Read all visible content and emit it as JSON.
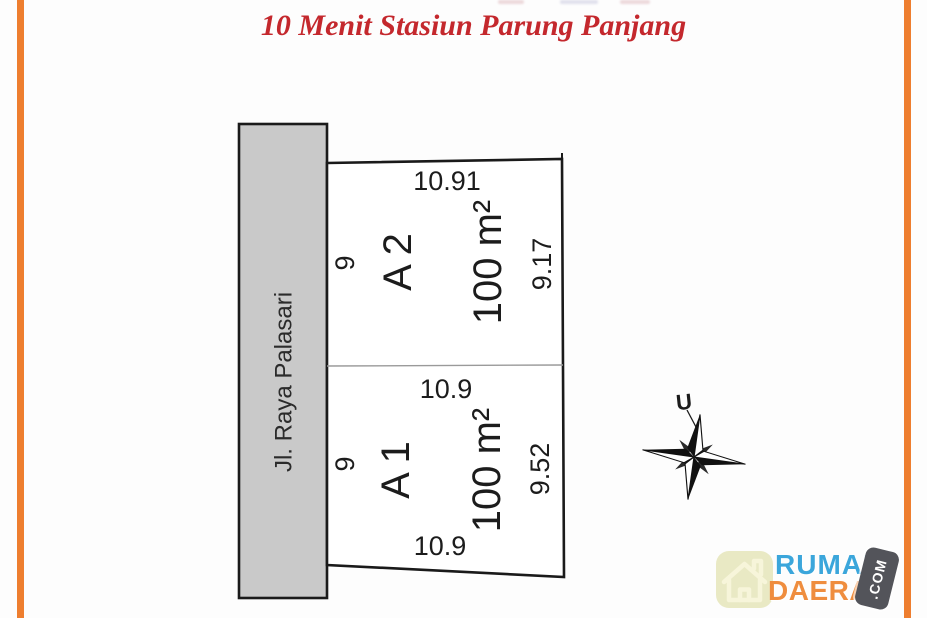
{
  "title": "10 Menit Stasiun Parung Panjang",
  "colors": {
    "accent_bar": "#ee7e2f",
    "title_red": "#c4282d",
    "road_fill": "#c9c9c9",
    "plot_line": "#1c1c1c",
    "divider_gray": "#9a9a9a",
    "logo_blue": "#3ba6db",
    "logo_orange": "#ef8d3e",
    "logo_tile_bg": "#e9e9c4",
    "logo_house_stroke": "#f7f5da",
    "com_tile_bg": "#53545a"
  },
  "site_plan": {
    "road_label": "Jl. Raya Palasari",
    "plots": [
      {
        "id": "A 2",
        "area": "100 m²",
        "dim_top": "10.91",
        "dim_left": "9",
        "dim_right": "9.17"
      },
      {
        "id": "A 1",
        "area": "100 m²",
        "dim_top": "10.9",
        "dim_left": "9",
        "dim_right": "9.52",
        "dim_bottom": "10.9"
      }
    ]
  },
  "compass": {
    "north_label": "U"
  },
  "logo": {
    "word1": "RUMAH",
    "word2": "DAERAH",
    "suffix": ".COM",
    "icon": "house-icon"
  }
}
